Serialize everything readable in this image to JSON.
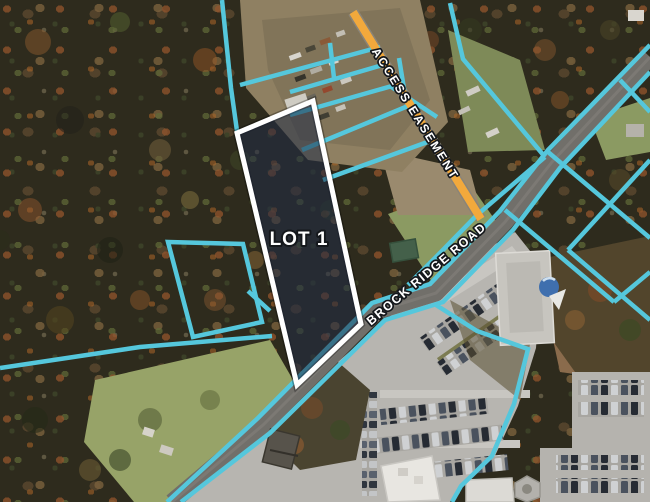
{
  "map": {
    "description": "Aerial parcel map with lot outline, access easement and road labels",
    "labels": {
      "lot": "LOT 1",
      "easement": "ACCESS EASEMENT",
      "road": "BROCK RIDGE ROAD"
    },
    "colors": {
      "parcel_boundary": "#55C7DC",
      "easement_line": "#F2A93C",
      "lot_outline": "#FFFFFF",
      "lot_fill": "rgba(32,44,70,0.55)",
      "label_fill": "#FFFFFF",
      "label_stroke": "#15181C"
    }
  }
}
